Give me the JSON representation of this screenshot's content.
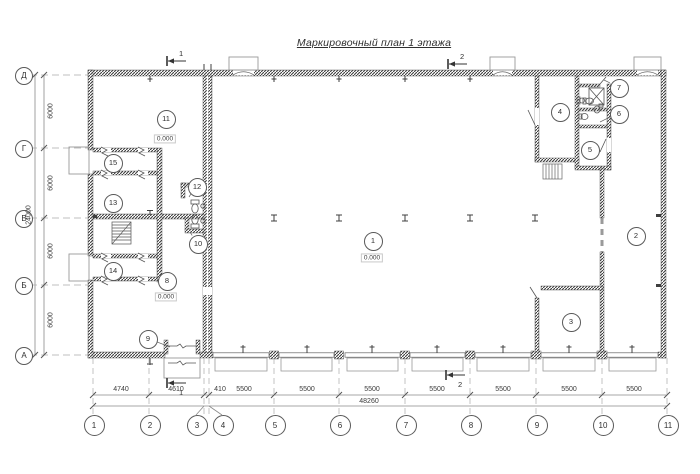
{
  "title": {
    "text": "Маркировочный план 1 этажа"
  },
  "axes": {
    "rows": [
      {
        "label": "Д",
        "y": 75
      },
      {
        "label": "Г",
        "y": 148
      },
      {
        "label": "В",
        "y": 218
      },
      {
        "label": "Б",
        "y": 285
      },
      {
        "label": "А",
        "y": 355
      }
    ],
    "cols": [
      {
        "label": "1",
        "x": 93,
        "cx": 93
      },
      {
        "label": "2",
        "x": 149,
        "cx": 149
      },
      {
        "label": "3",
        "x": 204,
        "cx": 196
      },
      {
        "label": "4",
        "x": 209,
        "cx": 222
      },
      {
        "label": "5",
        "x": 274,
        "cx": 274
      },
      {
        "label": "6",
        "x": 339,
        "cx": 339
      },
      {
        "label": "7",
        "x": 405,
        "cx": 405
      },
      {
        "label": "8",
        "x": 470,
        "cx": 470
      },
      {
        "label": "9",
        "x": 536,
        "cx": 536
      },
      {
        "label": "10",
        "x": 602,
        "cx": 602
      },
      {
        "label": "11",
        "x": 667,
        "cx": 667
      }
    ]
  },
  "dimensions": {
    "left_segments": [
      {
        "text": "6000",
        "y": 111
      },
      {
        "text": "6000",
        "y": 183
      },
      {
        "text": "6000",
        "y": 251
      },
      {
        "text": "6000",
        "y": 320
      }
    ],
    "left_total": {
      "text": "24000",
      "y": 215
    },
    "bottom_segments": [
      {
        "text": "4740",
        "x": 121
      },
      {
        "text": "4610",
        "x": 176
      },
      {
        "text": "410",
        "x": 220
      },
      {
        "text": "5500",
        "x": 244
      },
      {
        "text": "5500",
        "x": 307
      },
      {
        "text": "5500",
        "x": 372
      },
      {
        "text": "5500",
        "x": 437
      },
      {
        "text": "5500",
        "x": 503
      },
      {
        "text": "5500",
        "x": 569
      },
      {
        "text": "5500",
        "x": 634
      }
    ],
    "bottom_total": {
      "text": "48260",
      "x": 369
    }
  },
  "rooms": [
    {
      "n": "1",
      "x": 372,
      "y": 240
    },
    {
      "n": "2",
      "x": 635,
      "y": 235
    },
    {
      "n": "3",
      "x": 570,
      "y": 321
    },
    {
      "n": "4",
      "x": 559,
      "y": 111
    },
    {
      "n": "5",
      "x": 589,
      "y": 149
    },
    {
      "n": "6",
      "x": 618,
      "y": 113,
      "lx": 600,
      "ly": 122
    },
    {
      "n": "7",
      "x": 618,
      "y": 87,
      "lx": 604,
      "ly": 80
    },
    {
      "n": "8",
      "x": 166,
      "y": 280
    },
    {
      "n": "9",
      "x": 147,
      "y": 338,
      "lx": 170,
      "ly": 347
    },
    {
      "n": "10",
      "x": 197,
      "y": 243,
      "lx": 190,
      "ly": 232
    },
    {
      "n": "11",
      "x": 165,
      "y": 118
    },
    {
      "n": "12",
      "x": 196,
      "y": 186,
      "lx": 189,
      "ly": 197
    },
    {
      "n": "13",
      "x": 112,
      "y": 202
    },
    {
      "n": "14",
      "x": 112,
      "y": 270
    },
    {
      "n": "15",
      "x": 112,
      "y": 162
    }
  ],
  "levels": [
    {
      "text": "0.000",
      "x": 165,
      "y": 139
    },
    {
      "text": "0.000",
      "x": 372,
      "y": 258
    },
    {
      "text": "0.000",
      "x": 166,
      "y": 297
    }
  ],
  "sections": [
    {
      "label": "1",
      "x": 165,
      "y": 48,
      "pos": "above"
    },
    {
      "label": "2",
      "x": 446,
      "y": 51,
      "pos": "above"
    },
    {
      "label": "1",
      "x": 165,
      "y": 377,
      "pos": "below"
    },
    {
      "label": "2",
      "x": 444,
      "y": 369,
      "pos": "below"
    }
  ]
}
